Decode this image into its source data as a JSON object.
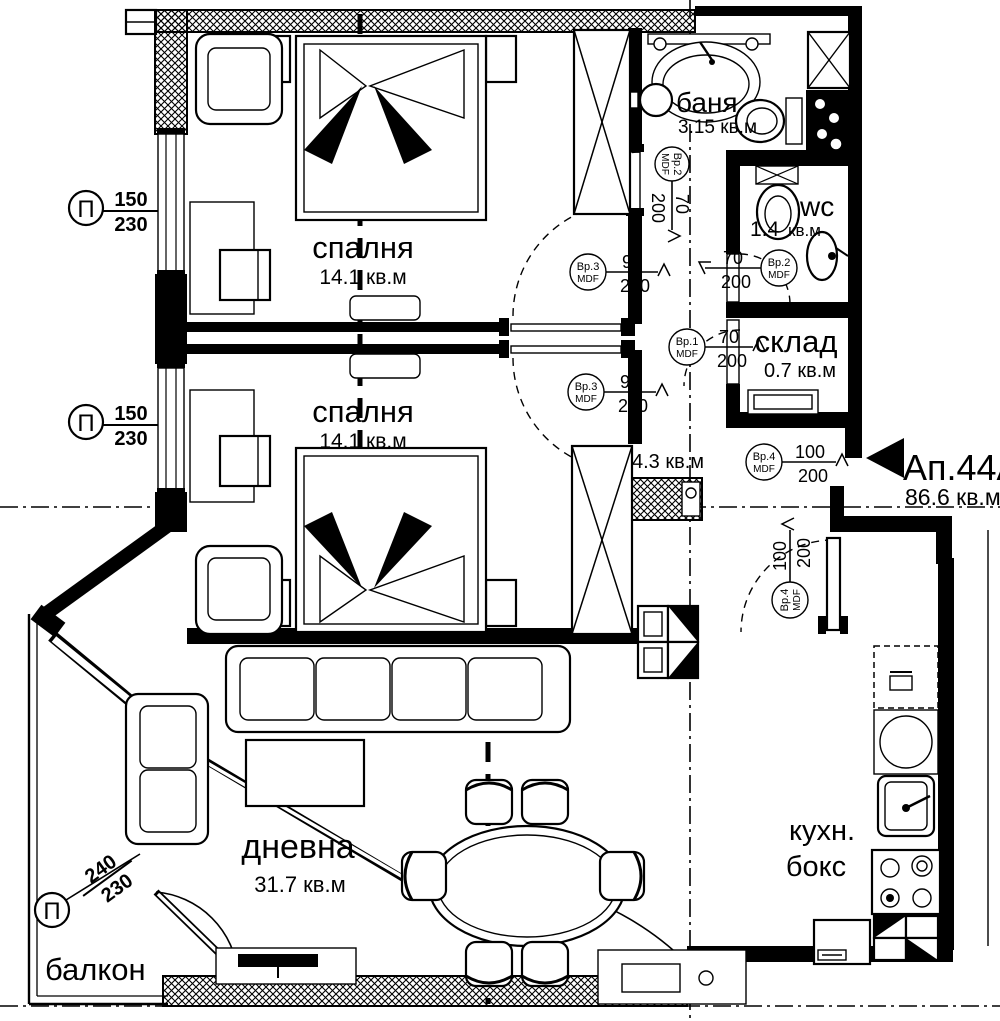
{
  "apartment": {
    "label": "Ап.44А",
    "area": "86.6 кв.м"
  },
  "rooms": {
    "bedroom1": {
      "name": "спалня",
      "area": "14.1 кв.м"
    },
    "bedroom2": {
      "name": "спалня",
      "area": "14.1 кв.м"
    },
    "bath": {
      "name": "баня",
      "area": "3.15 кв.м"
    },
    "wc": {
      "name": "wc",
      "area_num": "1.4",
      "area_unit": "кв.м"
    },
    "storage": {
      "name": "склад",
      "area": "0.7 кв.м"
    },
    "hall": {
      "area": "4.3 кв.м"
    },
    "living": {
      "name": "дневна",
      "area": "31.7 кв.м"
    },
    "kitchen_box": {
      "line1": "кухн.",
      "line2": "бокс"
    },
    "balcony": {
      "name": "балкон"
    }
  },
  "window_labels": [
    {
      "symbol": "П",
      "num": "150",
      "den": "230"
    },
    {
      "symbol": "П",
      "num": "150",
      "den": "230"
    },
    {
      "symbol": "П",
      "num": "240",
      "den": "230"
    }
  ],
  "door_labels": [
    {
      "id": "Вр.3",
      "material": "MDF",
      "num": "90",
      "den": "200"
    },
    {
      "id": "Вр.3",
      "material": "MDF",
      "num": "90",
      "den": "200"
    },
    {
      "id": "Вр.2",
      "material": "MDF",
      "num": "70",
      "den": "200"
    },
    {
      "id": "Вр.2",
      "material": "MDF",
      "num": "70",
      "den": "200"
    },
    {
      "id": "Вр.1",
      "material": "MDF",
      "num": "70",
      "den": "200"
    },
    {
      "id": "Вр.4",
      "material": "MDF",
      "num": "100",
      "den": "200"
    },
    {
      "id": "Вр.4",
      "material": "MDF",
      "num": "100",
      "den": "200"
    }
  ],
  "colors": {
    "ink": "#000000",
    "paper": "#ffffff"
  }
}
